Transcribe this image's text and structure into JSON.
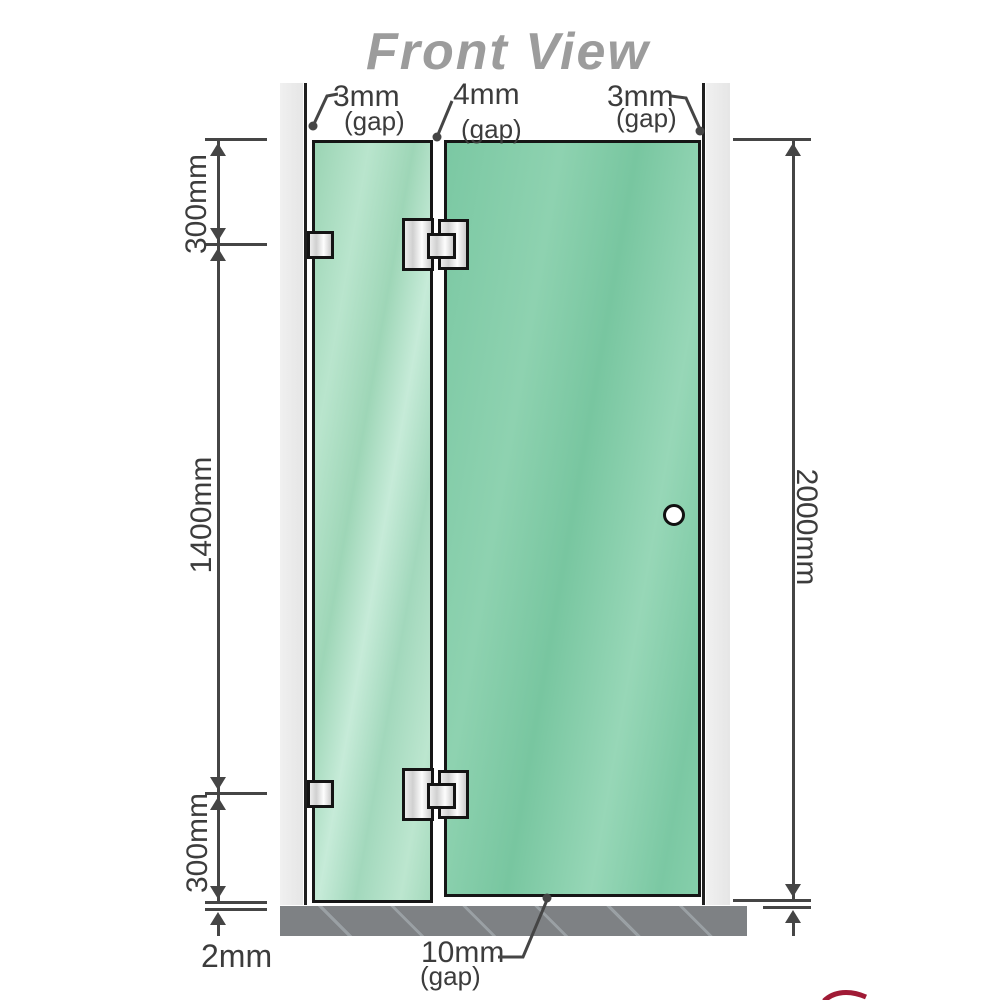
{
  "title": "Front View",
  "annotations": {
    "gap_top_left": {
      "value": "3mm",
      "suffix": "(gap)"
    },
    "gap_top_mid": {
      "value": "4mm",
      "suffix": "(gap)"
    },
    "gap_top_right": {
      "value": "3mm",
      "suffix": "(gap)"
    },
    "seg_top": "300mm",
    "seg_mid": "1400mm",
    "seg_bottom": "300mm",
    "total_height": "2000mm",
    "floor_clearance": "2mm",
    "gap_bottom": {
      "value": "10mm",
      "suffix": "(gap)"
    }
  },
  "measurements": {
    "panel_total_height_mm": 2000,
    "hinge_offset_top_mm": 300,
    "hinge_spacing_mm": 1400,
    "hinge_offset_bottom_mm": 300,
    "wall_gap_left_mm": 3,
    "panel_gap_mm": 4,
    "wall_gap_right_mm": 3,
    "floor_gap_mm": 10,
    "base_gap_mm": 2
  },
  "colors": {
    "glass_right": "#7bc8a3",
    "glass_left": "#a9dcc2",
    "wall": "#eaeaea",
    "floor": "#7e8184",
    "dimension_line": "#454545",
    "title_text": "#9c9c9c",
    "accent_red": "#a01a35"
  }
}
